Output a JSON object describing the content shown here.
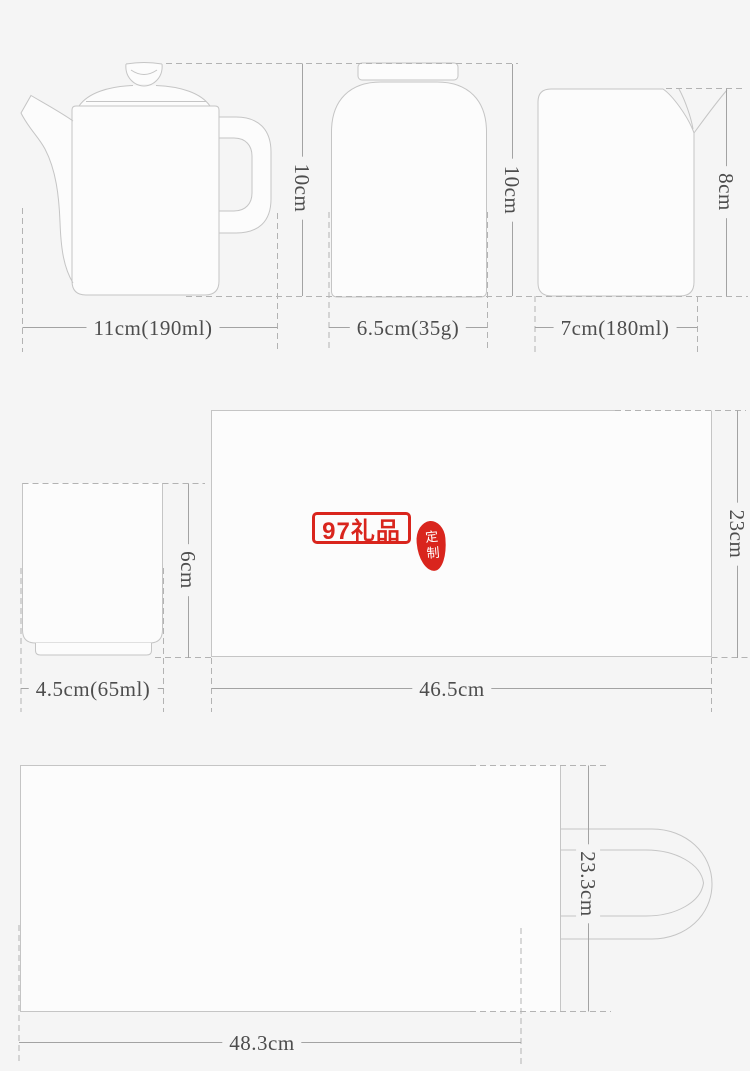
{
  "canvas": {
    "width": 750,
    "height": 1071,
    "background": "#f5f5f5"
  },
  "palette": {
    "shape_fill": "#fcfcfc",
    "outline": "#c5c5c5",
    "dashed_line": "#b3b3b3",
    "dimension_line": "#a3a3a3",
    "label_text": "#4d4d4d",
    "accent_red": "#d9251d",
    "seal_text_color": "#ffffff"
  },
  "items": {
    "teapot": {
      "width_label": "11cm(190ml)",
      "height_label": "10cm"
    },
    "canister": {
      "width_label": "6.5cm(35g)",
      "height_label": "10cm"
    },
    "cup": {
      "width_label": "7cm(180ml)",
      "height_label": "8cm"
    },
    "small_cup": {
      "width_label": "4.5cm(65ml)",
      "height_label": "6cm"
    },
    "tray": {
      "width_label": "46.5cm",
      "height_label": "23cm"
    },
    "bag": {
      "width_label": "48.3cm",
      "height_label": "23.3cm"
    }
  },
  "watermark": {
    "logo_text": "97礼品",
    "seal_text": "定制"
  }
}
